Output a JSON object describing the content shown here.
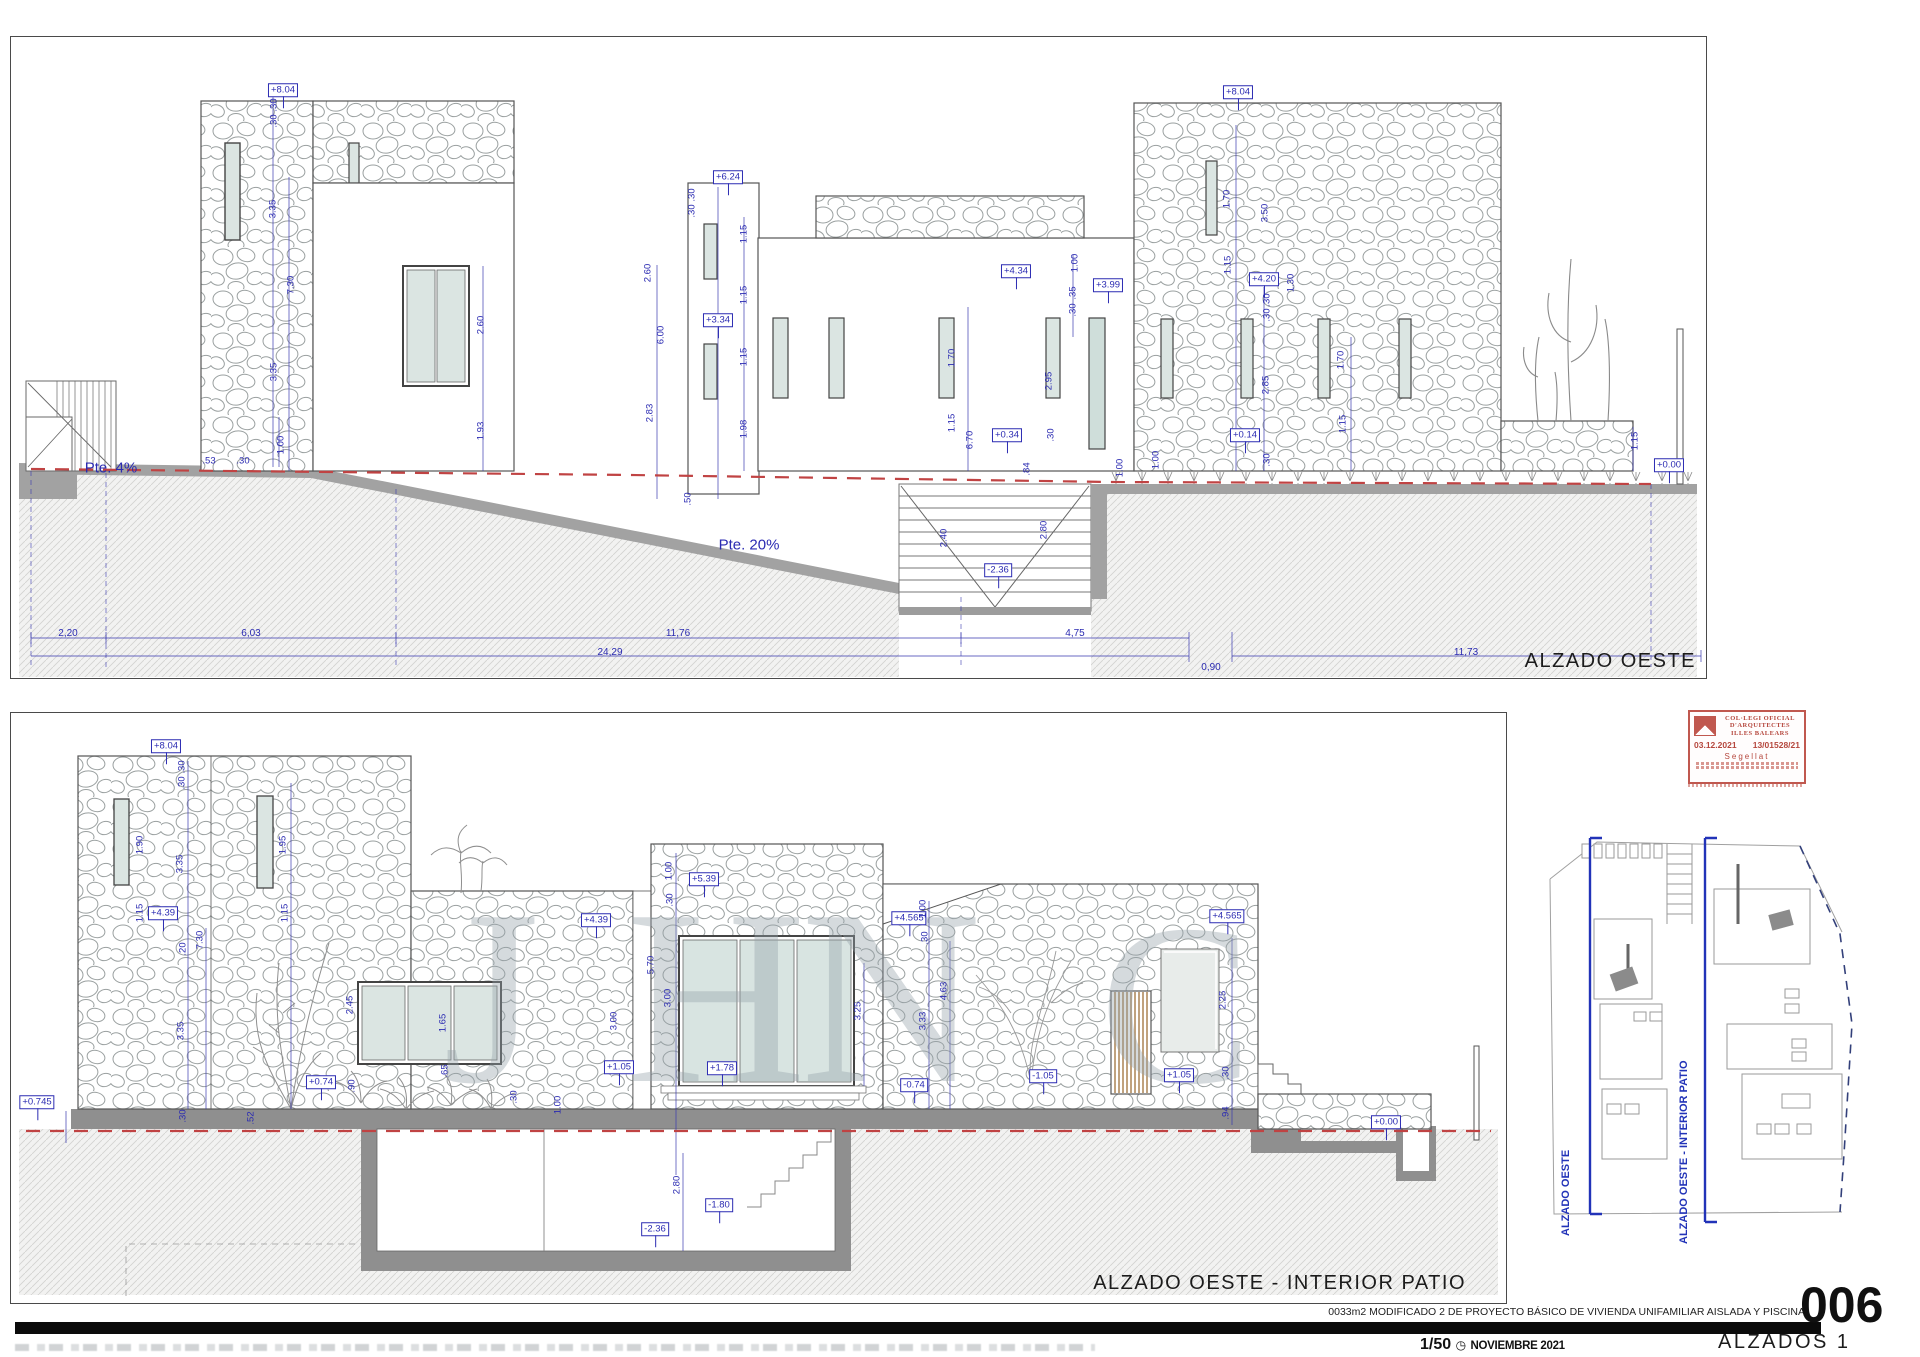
{
  "colors": {
    "dim_blue": "#2b2bb2",
    "ground_red": "#c04343",
    "stamp_red": "#c0584f"
  },
  "top_panel": {
    "title": "ALZADO OESTE",
    "slope_left": "Pte. 4%",
    "slope_right": "Pte. 20%",
    "levels": [
      {
        "x": 272,
        "y": 53,
        "t": "+8.04"
      },
      {
        "x": 717,
        "y": 140,
        "t": "+6.24"
      },
      {
        "x": 707,
        "y": 283,
        "t": "+3.34"
      },
      {
        "x": 1005,
        "y": 234,
        "t": "+4.34"
      },
      {
        "x": 1097,
        "y": 248,
        "t": "+3.99"
      },
      {
        "x": 1227,
        "y": 55,
        "t": "+8.04"
      },
      {
        "x": 1253,
        "y": 242,
        "t": "+4.20"
      },
      {
        "x": 996,
        "y": 398,
        "t": "+0.34"
      },
      {
        "x": 1234,
        "y": 398,
        "t": "+0.14"
      },
      {
        "x": 987,
        "y": 533,
        "t": "-2.36"
      },
      {
        "x": 1658,
        "y": 428,
        "t": "+0.00"
      }
    ],
    "dims": [
      {
        "x": 263,
        "y": 68,
        "t": ".30",
        "v": 1
      },
      {
        "x": 263,
        "y": 84,
        "t": ".30",
        "v": 1
      },
      {
        "x": 262,
        "y": 172,
        "t": "3.35",
        "v": 1
      },
      {
        "x": 280,
        "y": 248,
        "t": "7.30",
        "v": 1
      },
      {
        "x": 263,
        "y": 335,
        "t": "3.35",
        "v": 1
      },
      {
        "x": 198,
        "y": 424,
        "t": ".53"
      },
      {
        "x": 232,
        "y": 424,
        "t": ".30"
      },
      {
        "x": 470,
        "y": 288,
        "t": "2.60",
        "v": 1
      },
      {
        "x": 470,
        "y": 394,
        "t": "1.93",
        "v": 1
      },
      {
        "x": 681,
        "y": 158,
        "t": ".30",
        "v": 1
      },
      {
        "x": 681,
        "y": 174,
        "t": ".30",
        "v": 1
      },
      {
        "x": 637,
        "y": 236,
        "t": "2.60",
        "v": 1
      },
      {
        "x": 650,
        "y": 298,
        "t": "6.00",
        "v": 1
      },
      {
        "x": 639,
        "y": 376,
        "t": "2.83",
        "v": 1
      },
      {
        "x": 733,
        "y": 197,
        "t": "1.15",
        "v": 1
      },
      {
        "x": 733,
        "y": 258,
        "t": "1.15",
        "v": 1
      },
      {
        "x": 733,
        "y": 320,
        "t": "1.15",
        "v": 1
      },
      {
        "x": 733,
        "y": 392,
        "t": "1.98",
        "v": 1
      },
      {
        "x": 677,
        "y": 462,
        "t": ".50",
        "v": 1
      },
      {
        "x": 941,
        "y": 321,
        "t": "1.70",
        "v": 1
      },
      {
        "x": 941,
        "y": 386,
        "t": "1.15",
        "v": 1
      },
      {
        "x": 959,
        "y": 403,
        "t": "6.70",
        "v": 1
      },
      {
        "x": 1016,
        "y": 432,
        "t": ".84",
        "v": 1
      },
      {
        "x": 1040,
        "y": 398,
        "t": ".30",
        "v": 1
      },
      {
        "x": 1038,
        "y": 344,
        "t": "2.95",
        "v": 1
      },
      {
        "x": 270,
        "y": 408,
        "t": "1.00",
        "v": 1
      },
      {
        "x": 933,
        "y": 501,
        "t": "2.40",
        "v": 1
      },
      {
        "x": 1033,
        "y": 493,
        "t": "2.80",
        "v": 1
      },
      {
        "x": 1109,
        "y": 431,
        "t": "1.00",
        "v": 1
      },
      {
        "x": 1216,
        "y": 162,
        "t": "1.70",
        "v": 1
      },
      {
        "x": 1254,
        "y": 176,
        "t": "3.50",
        "v": 1
      },
      {
        "x": 1217,
        "y": 228,
        "t": "1.15",
        "v": 1
      },
      {
        "x": 1280,
        "y": 246,
        "t": "1.30",
        "v": 1
      },
      {
        "x": 1256,
        "y": 263,
        "t": ".30",
        "v": 1
      },
      {
        "x": 1256,
        "y": 278,
        "t": ".30",
        "v": 1
      },
      {
        "x": 1255,
        "y": 348,
        "t": "2.85",
        "v": 1
      },
      {
        "x": 1330,
        "y": 323,
        "t": "1.70",
        "v": 1
      },
      {
        "x": 1332,
        "y": 387,
        "t": "1.15",
        "v": 1
      },
      {
        "x": 1256,
        "y": 423,
        "t": ".30",
        "v": 1
      },
      {
        "x": 1145,
        "y": 423,
        "t": "1.00",
        "v": 1
      },
      {
        "x": 1064,
        "y": 226,
        "t": "1.00",
        "v": 1
      },
      {
        "x": 1062,
        "y": 256,
        "t": ".35",
        "v": 1
      },
      {
        "x": 1062,
        "y": 273,
        "t": ".30",
        "v": 1
      },
      {
        "x": 1624,
        "y": 404,
        "t": "1.15",
        "v": 1
      }
    ],
    "chain": [
      {
        "x": 57,
        "y": 597,
        "t": "2,20"
      },
      {
        "x": 240,
        "y": 597,
        "t": "6,03"
      },
      {
        "x": 667,
        "y": 597,
        "t": "11,76"
      },
      {
        "x": 1064,
        "y": 597,
        "t": "4,75"
      },
      {
        "x": 599,
        "y": 616,
        "t": "24,29"
      },
      {
        "x": 1200,
        "y": 631,
        "t": "0,90"
      },
      {
        "x": 1455,
        "y": 616,
        "t": "11,73"
      }
    ]
  },
  "bottom_panel": {
    "title": "ALZADO OESTE - INTERIOR PATIO",
    "levels": [
      {
        "x": 155,
        "y": 33,
        "t": "+8.04"
      },
      {
        "x": 152,
        "y": 200,
        "t": "+4.39"
      },
      {
        "x": 585,
        "y": 207,
        "t": "+4.39"
      },
      {
        "x": 693,
        "y": 166,
        "t": "+5.39"
      },
      {
        "x": 898,
        "y": 205,
        "t": "+4.565"
      },
      {
        "x": 1216,
        "y": 203,
        "t": "+4.565"
      },
      {
        "x": 903,
        "y": 372,
        "t": "-0.74"
      },
      {
        "x": 310,
        "y": 369,
        "t": "+0.74"
      },
      {
        "x": 608,
        "y": 354,
        "t": "+1.05"
      },
      {
        "x": 711,
        "y": 355,
        "t": "+1.78"
      },
      {
        "x": 1032,
        "y": 363,
        "t": "-1.05"
      },
      {
        "x": 1168,
        "y": 362,
        "t": "+1.05"
      },
      {
        "x": 1375,
        "y": 409,
        "t": "+0.00"
      },
      {
        "x": 26,
        "y": 389,
        "t": "+0.745"
      },
      {
        "x": 708,
        "y": 492,
        "t": "-1.80"
      },
      {
        "x": 644,
        "y": 516,
        "t": "-2.36"
      }
    ],
    "dims": [
      {
        "x": 171,
        "y": 54,
        "t": ".30",
        "v": 1
      },
      {
        "x": 171,
        "y": 70,
        "t": ".30",
        "v": 1
      },
      {
        "x": 129,
        "y": 132,
        "t": "1.90",
        "v": 1
      },
      {
        "x": 169,
        "y": 151,
        "t": "3.35",
        "v": 1
      },
      {
        "x": 129,
        "y": 200,
        "t": "1.15",
        "v": 1
      },
      {
        "x": 189,
        "y": 227,
        "t": "7.30",
        "v": 1
      },
      {
        "x": 172,
        "y": 236,
        "t": ".20",
        "v": 1
      },
      {
        "x": 170,
        "y": 318,
        "t": "3.35",
        "v": 1
      },
      {
        "x": 272,
        "y": 132,
        "t": "1.95",
        "v": 1
      },
      {
        "x": 274,
        "y": 200,
        "t": "1.15",
        "v": 1
      },
      {
        "x": 339,
        "y": 292,
        "t": "2.45",
        "v": 1
      },
      {
        "x": 432,
        "y": 310,
        "t": "1.65",
        "v": 1
      },
      {
        "x": 434,
        "y": 358,
        "t": ".65",
        "v": 1
      },
      {
        "x": 341,
        "y": 373,
        "t": ".90",
        "v": 1
      },
      {
        "x": 172,
        "y": 403,
        "t": ".30",
        "v": 1
      },
      {
        "x": 240,
        "y": 405,
        "t": ".52",
        "v": 1
      },
      {
        "x": 503,
        "y": 384,
        "t": ".30",
        "v": 1
      },
      {
        "x": 658,
        "y": 158,
        "t": "1.00",
        "v": 1
      },
      {
        "x": 659,
        "y": 187,
        "t": ".30",
        "v": 1
      },
      {
        "x": 640,
        "y": 252,
        "t": "5.70",
        "v": 1
      },
      {
        "x": 657,
        "y": 285,
        "t": "3.00",
        "v": 1
      },
      {
        "x": 603,
        "y": 308,
        "t": "3.00",
        "v": 1
      },
      {
        "x": 847,
        "y": 298,
        "t": "3.25",
        "v": 1
      },
      {
        "x": 912,
        "y": 308,
        "t": "3.33",
        "v": 1
      },
      {
        "x": 933,
        "y": 278,
        "t": "4.63",
        "v": 1
      },
      {
        "x": 912,
        "y": 196,
        "t": "1.00",
        "v": 1
      },
      {
        "x": 914,
        "y": 225,
        "t": ".30",
        "v": 1
      },
      {
        "x": 1212,
        "y": 287,
        "t": "2.25",
        "v": 1
      },
      {
        "x": 1215,
        "y": 360,
        "t": ".30",
        "v": 1
      },
      {
        "x": 1215,
        "y": 400,
        "t": ".94",
        "v": 1
      },
      {
        "x": 666,
        "y": 472,
        "t": "2.80",
        "v": 1
      },
      {
        "x": 547,
        "y": 392,
        "t": "1.00",
        "v": 1
      }
    ],
    "watermark": [
      {
        "x": 480,
        "y": 285,
        "t": "J",
        "s": 250
      },
      {
        "x": 705,
        "y": 285,
        "t": "H",
        "s": 250
      },
      {
        "x": 880,
        "y": 285,
        "t": "N",
        "s": 250
      },
      {
        "x": 1165,
        "y": 292,
        "t": "C",
        "s": 230
      }
    ]
  },
  "stamp": {
    "name1": "COL·LEGI OFICIAL",
    "name2": "D'ARQUITECTES",
    "name3": "ILLES BALEARS",
    "date": "03.12.2021",
    "ref": "13/01528/21",
    "seal": "Segellat"
  },
  "key_plan": {
    "section_a": "ALZADO OESTE",
    "section_b": "ALZADO OESTE - INTERIOR PATIO"
  },
  "title_block": {
    "project": "0033m2   MODIFICADO 2 DE PROYECTO BÁSICO DE VIVIENDA UNIFAMILIAR AISLADA Y PISCINA",
    "scale": "1/50",
    "clock": "◷",
    "date": "NOVIEMBRE 2021",
    "sheet_number": "006",
    "sheet_name": "ALZADOS 1"
  }
}
